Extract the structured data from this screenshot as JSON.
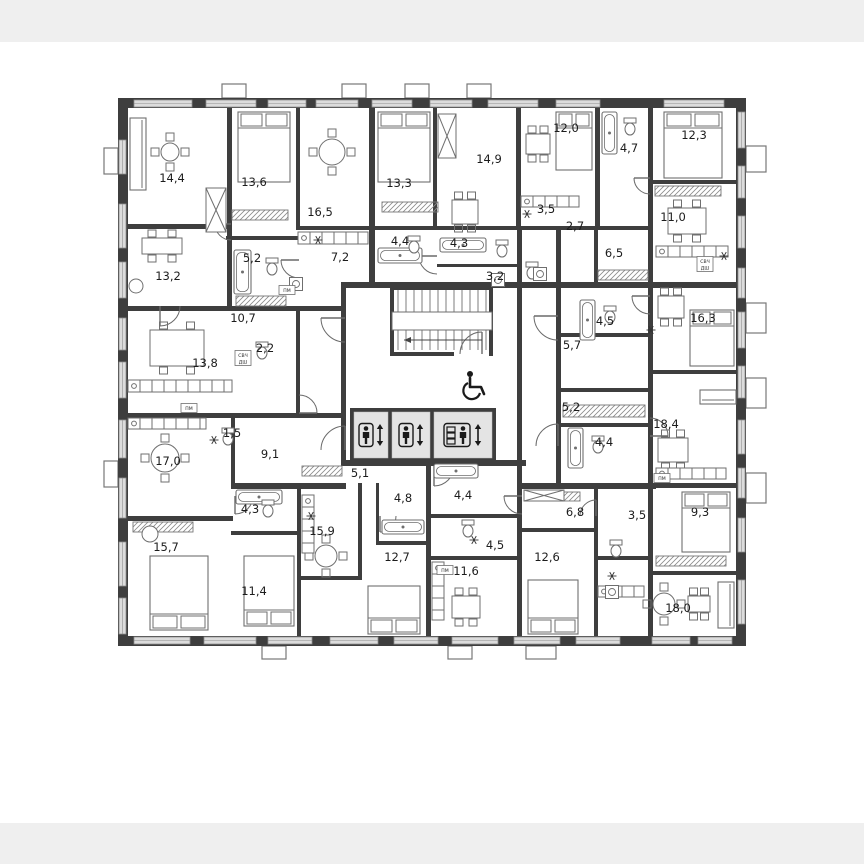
{
  "meta": {
    "bands": {
      "top": [
        0,
        0,
        864,
        42
      ],
      "bottom": [
        0,
        823,
        864,
        41
      ],
      "color": "#efefef"
    },
    "colors": {
      "paper": "#ffffff",
      "wall": "#3e3e3e",
      "window_fill": "#dcdcdc",
      "window_stroke": "#909090",
      "furn": "#6f6f6f",
      "hatch": "#8a8a8a",
      "lift_fill": "#e4e4e4",
      "icon": "#1a1a1a",
      "label": "#1c1c1c",
      "door": "#6a6a6a"
    }
  },
  "plan": {
    "base": [
      118,
      98,
      628,
      548
    ],
    "walls": [
      [
        118,
        98,
        628,
        10
      ],
      [
        118,
        636,
        628,
        10
      ],
      [
        118,
        98,
        10,
        548
      ],
      [
        736,
        98,
        10,
        548
      ],
      [
        227,
        108,
        5,
        198
      ],
      [
        296,
        108,
        4,
        120
      ],
      [
        369,
        108,
        6,
        176
      ],
      [
        433,
        108,
        4,
        120
      ],
      [
        516,
        108,
        5,
        120
      ],
      [
        595,
        108,
        5,
        120
      ],
      [
        648,
        108,
        5,
        538
      ],
      [
        126,
        224,
        101,
        5
      ],
      [
        226,
        236,
        74,
        4
      ],
      [
        296,
        226,
        141,
        4
      ],
      [
        433,
        226,
        217,
        4
      ],
      [
        648,
        180,
        89,
        4
      ],
      [
        648,
        370,
        89,
        4
      ],
      [
        648,
        483,
        89,
        5
      ],
      [
        648,
        571,
        89,
        4
      ],
      [
        341,
        282,
        405,
        6
      ],
      [
        126,
        306,
        220,
        5
      ],
      [
        126,
        413,
        220,
        5
      ],
      [
        126,
        516,
        107,
        5
      ],
      [
        296,
        306,
        4,
        107
      ],
      [
        231,
        413,
        4,
        70
      ],
      [
        556,
        230,
        5,
        253
      ],
      [
        517,
        228,
        5,
        418
      ],
      [
        594,
        230,
        4,
        54
      ],
      [
        556,
        333,
        92,
        4
      ],
      [
        556,
        388,
        92,
        4
      ],
      [
        556,
        423,
        92,
        4
      ],
      [
        341,
        282,
        5,
        178
      ],
      [
        231,
        483,
        115,
        6
      ],
      [
        341,
        460,
        185,
        6
      ],
      [
        519,
        483,
        137,
        6
      ],
      [
        297,
        483,
        4,
        153
      ],
      [
        358,
        483,
        4,
        97
      ],
      [
        426,
        460,
        5,
        176
      ],
      [
        376,
        483,
        3,
        60
      ],
      [
        376,
        541,
        54,
        4
      ],
      [
        428,
        514,
        92,
        4
      ],
      [
        428,
        556,
        92,
        4
      ],
      [
        517,
        528,
        80,
        4
      ],
      [
        594,
        483,
        4,
        155
      ],
      [
        594,
        556,
        56,
        4
      ],
      [
        231,
        531,
        68,
        4
      ],
      [
        300,
        576,
        58,
        4
      ],
      [
        437,
        264,
        82,
        3
      ],
      [
        390,
        286,
        4,
        70
      ],
      [
        489,
        286,
        4,
        70
      ],
      [
        390,
        286,
        103,
        4
      ],
      [
        390,
        352,
        64,
        4
      ],
      [
        350,
        408,
        146,
        4
      ],
      [
        350,
        458,
        146,
        4
      ],
      [
        350,
        408,
        4,
        54
      ],
      [
        492,
        408,
        4,
        54
      ],
      [
        388,
        408,
        4,
        54
      ],
      [
        430,
        408,
        4,
        54
      ]
    ],
    "windows": [
      [
        134,
        100,
        58,
        7
      ],
      [
        206,
        100,
        50,
        7
      ],
      [
        268,
        100,
        38,
        7
      ],
      [
        316,
        100,
        42,
        7
      ],
      [
        372,
        100,
        40,
        7
      ],
      [
        430,
        100,
        42,
        7
      ],
      [
        488,
        100,
        50,
        7
      ],
      [
        556,
        100,
        44,
        7
      ],
      [
        664,
        100,
        60,
        7
      ],
      [
        134,
        637,
        56,
        7
      ],
      [
        204,
        637,
        52,
        7
      ],
      [
        268,
        637,
        44,
        7
      ],
      [
        330,
        637,
        48,
        7
      ],
      [
        394,
        637,
        44,
        7
      ],
      [
        452,
        637,
        46,
        7
      ],
      [
        514,
        637,
        46,
        7
      ],
      [
        576,
        637,
        44,
        7
      ],
      [
        652,
        637,
        38,
        7
      ],
      [
        698,
        637,
        34,
        7
      ],
      [
        119,
        140,
        7,
        34
      ],
      [
        119,
        204,
        7,
        44
      ],
      [
        119,
        262,
        7,
        36
      ],
      [
        119,
        318,
        7,
        32
      ],
      [
        119,
        362,
        7,
        36
      ],
      [
        119,
        420,
        7,
        38
      ],
      [
        119,
        478,
        7,
        40
      ],
      [
        119,
        542,
        7,
        44
      ],
      [
        119,
        598,
        7,
        36
      ],
      [
        738,
        112,
        7,
        36
      ],
      [
        738,
        166,
        7,
        32
      ],
      [
        738,
        216,
        7,
        32
      ],
      [
        738,
        268,
        7,
        30
      ],
      [
        738,
        312,
        7,
        36
      ],
      [
        738,
        366,
        7,
        32
      ],
      [
        738,
        420,
        7,
        34
      ],
      [
        738,
        468,
        7,
        30
      ],
      [
        738,
        518,
        7,
        34
      ],
      [
        738,
        580,
        7,
        44
      ]
    ],
    "protrusions": [
      [
        222,
        84,
        24,
        14
      ],
      [
        342,
        84,
        24,
        14
      ],
      [
        405,
        84,
        24,
        14
      ],
      [
        467,
        84,
        24,
        14
      ],
      [
        262,
        646,
        24,
        13
      ],
      [
        448,
        646,
        24,
        13
      ],
      [
        526,
        646,
        30,
        13
      ],
      [
        104,
        148,
        14,
        26
      ],
      [
        104,
        461,
        14,
        26
      ],
      [
        746,
        146,
        20,
        26
      ],
      [
        746,
        303,
        20,
        30
      ],
      [
        746,
        378,
        20,
        30
      ],
      [
        746,
        473,
        20,
        30
      ]
    ],
    "hatches": [
      [
        232,
        210,
        56,
        10
      ],
      [
        382,
        202,
        56,
        10
      ],
      [
        655,
        186,
        66,
        10
      ],
      [
        563,
        405,
        82,
        12
      ],
      [
        302,
        466,
        40,
        10
      ],
      [
        133,
        522,
        60,
        10
      ],
      [
        524,
        492,
        56,
        9
      ],
      [
        656,
        556,
        70,
        10
      ],
      [
        598,
        270,
        50,
        10
      ],
      [
        236,
        296,
        50,
        10
      ]
    ],
    "doors": [
      [
        345,
        318,
        24,
        90
      ],
      [
        345,
        450,
        24,
        180
      ],
      [
        558,
        316,
        24,
        90
      ],
      [
        558,
        446,
        22,
        180
      ],
      [
        434,
        466,
        20,
        0
      ],
      [
        299,
        260,
        18,
        90
      ],
      [
        437,
        256,
        18,
        90
      ],
      [
        650,
        296,
        18,
        90
      ],
      [
        650,
        436,
        18,
        270
      ],
      [
        235,
        496,
        18,
        0
      ],
      [
        380,
        516,
        16,
        0
      ],
      [
        522,
        496,
        18,
        90
      ],
      [
        596,
        516,
        16,
        180
      ],
      [
        160,
        306,
        20,
        0
      ],
      [
        482,
        354,
        22,
        180
      ],
      [
        650,
        178,
        16,
        90
      ],
      [
        299,
        413,
        18,
        270
      ],
      [
        231,
        224,
        16,
        90
      ]
    ],
    "rooms": [
      {
        "label": "14,4",
        "x": 172,
        "y": 182
      },
      {
        "label": "13,6",
        "x": 254,
        "y": 186
      },
      {
        "label": "16,5",
        "x": 320,
        "y": 216
      },
      {
        "label": "13,3",
        "x": 399,
        "y": 187
      },
      {
        "label": "14,9",
        "x": 489,
        "y": 163
      },
      {
        "label": "12,0",
        "x": 566,
        "y": 132
      },
      {
        "label": "4,7",
        "x": 629,
        "y": 152
      },
      {
        "label": "12,3",
        "x": 694,
        "y": 139
      },
      {
        "label": "11,0",
        "x": 673,
        "y": 221
      },
      {
        "label": "3,5",
        "x": 546,
        "y": 213
      },
      {
        "label": "2,7",
        "x": 575,
        "y": 230
      },
      {
        "label": "6,5",
        "x": 614,
        "y": 257
      },
      {
        "label": "16,3",
        "x": 703,
        "y": 322
      },
      {
        "label": "5,2",
        "x": 252,
        "y": 262
      },
      {
        "label": "7,2",
        "x": 340,
        "y": 261
      },
      {
        "label": "13,2",
        "x": 168,
        "y": 280
      },
      {
        "label": "4,4",
        "x": 400,
        "y": 245
      },
      {
        "label": "4,3",
        "x": 459,
        "y": 247
      },
      {
        "label": "3,2",
        "x": 495,
        "y": 280
      },
      {
        "label": "10,7",
        "x": 243,
        "y": 322
      },
      {
        "label": "2,2",
        "x": 265,
        "y": 352
      },
      {
        "label": "13,8",
        "x": 205,
        "y": 367
      },
      {
        "label": "4,5",
        "x": 605,
        "y": 325
      },
      {
        "label": "5,7",
        "x": 572,
        "y": 349
      },
      {
        "label": "1,5",
        "x": 232,
        "y": 437
      },
      {
        "label": "17,0",
        "x": 168,
        "y": 465
      },
      {
        "label": "9,1",
        "x": 270,
        "y": 458
      },
      {
        "label": "5,2",
        "x": 571,
        "y": 411
      },
      {
        "label": "4,4",
        "x": 604,
        "y": 446
      },
      {
        "label": "18,4",
        "x": 666,
        "y": 428
      },
      {
        "label": "5,1",
        "x": 360,
        "y": 477
      },
      {
        "label": "4,8",
        "x": 403,
        "y": 502
      },
      {
        "label": "4,4",
        "x": 463,
        "y": 499
      },
      {
        "label": "4,5",
        "x": 495,
        "y": 549
      },
      {
        "label": "6,8",
        "x": 575,
        "y": 516
      },
      {
        "label": "3,5",
        "x": 637,
        "y": 519
      },
      {
        "label": "9,3",
        "x": 700,
        "y": 516
      },
      {
        "label": "15,7",
        "x": 166,
        "y": 551
      },
      {
        "label": "4,3",
        "x": 250,
        "y": 513
      },
      {
        "label": "15,9",
        "x": 322,
        "y": 535
      },
      {
        "label": "12,7",
        "x": 397,
        "y": 561
      },
      {
        "label": "11,6",
        "x": 466,
        "y": 575
      },
      {
        "label": "12,6",
        "x": 547,
        "y": 561
      },
      {
        "label": "11,4",
        "x": 254,
        "y": 595
      },
      {
        "label": "18,0",
        "x": 678,
        "y": 612
      }
    ],
    "furniture": {
      "beds": [
        [
          238,
          112,
          52,
          70,
          0
        ],
        [
          378,
          112,
          52,
          70,
          0
        ],
        [
          664,
          112,
          58,
          66,
          0
        ],
        [
          690,
          310,
          44,
          56,
          0
        ],
        [
          556,
          112,
          36,
          58,
          0
        ],
        [
          682,
          492,
          48,
          60,
          0
        ],
        [
          150,
          556,
          58,
          74,
          1
        ],
        [
          244,
          556,
          50,
          70,
          1
        ],
        [
          368,
          586,
          52,
          48,
          1
        ],
        [
          528,
          580,
          50,
          54,
          1
        ]
      ],
      "sofas": [
        [
          130,
          118,
          16,
          72
        ],
        [
          700,
          390,
          36,
          14
        ],
        [
          718,
          582,
          16,
          46
        ]
      ],
      "round_tables": [
        [
          170,
          152,
          9
        ],
        [
          332,
          152,
          13
        ],
        [
          165,
          458,
          14
        ],
        [
          326,
          556,
          11
        ],
        [
          664,
          604,
          11
        ]
      ],
      "tables": [
        [
          150,
          330,
          54,
          36
        ],
        [
          452,
          200,
          26,
          24
        ],
        [
          668,
          208,
          38,
          26
        ],
        [
          526,
          134,
          24,
          20
        ],
        [
          658,
          296,
          26,
          22
        ],
        [
          658,
          438,
          30,
          24
        ],
        [
          452,
          596,
          28,
          22
        ],
        [
          688,
          596,
          22,
          16
        ],
        [
          142,
          238,
          40,
          16
        ]
      ],
      "kitchens": [
        [
          298,
          232,
          70,
          12
        ],
        [
          521,
          196,
          58,
          11
        ],
        [
          656,
          246,
          72,
          11
        ],
        [
          128,
          380,
          104,
          12
        ],
        [
          128,
          418,
          78,
          11
        ],
        [
          302,
          495,
          12,
          58
        ],
        [
          432,
          562,
          12,
          58
        ],
        [
          656,
          468,
          70,
          11
        ],
        [
          598,
          586,
          46,
          11
        ]
      ],
      "tubs": [
        [
          234,
          250,
          17,
          44
        ],
        [
          378,
          248,
          44,
          15
        ],
        [
          440,
          238,
          46,
          14
        ],
        [
          602,
          112,
          15,
          42
        ],
        [
          580,
          300,
          15,
          40
        ],
        [
          568,
          428,
          15,
          40
        ],
        [
          236,
          490,
          46,
          14
        ],
        [
          382,
          520,
          42,
          14
        ],
        [
          434,
          464,
          44,
          14
        ]
      ],
      "wcs": [
        [
          272,
          258
        ],
        [
          414,
          236
        ],
        [
          502,
          240
        ],
        [
          630,
          118
        ],
        [
          532,
          262
        ],
        [
          610,
          306
        ],
        [
          598,
          436
        ],
        [
          262,
          342
        ],
        [
          228,
          428
        ],
        [
          268,
          500
        ],
        [
          468,
          520
        ],
        [
          616,
          540
        ]
      ],
      "wms": [
        [
          296,
          284
        ],
        [
          498,
          280
        ],
        [
          540,
          274
        ],
        [
          612,
          592
        ]
      ],
      "wardrobes": [
        [
          206,
          188,
          20,
          44
        ],
        [
          438,
          114,
          18,
          44
        ],
        [
          524,
          490,
          40,
          11
        ]
      ],
      "chairs": [
        [
          150,
          534,
          8
        ],
        [
          136,
          286,
          7
        ]
      ]
    },
    "snowflakes": [
      [
        318,
        240
      ],
      [
        527,
        214
      ],
      [
        724,
        256
      ],
      [
        651,
        330
      ],
      [
        214,
        440
      ],
      [
        311,
        516
      ],
      [
        474,
        540
      ],
      [
        612,
        576
      ]
    ],
    "appliance_labels": [
      {
        "lines": [
          "ПМ"
        ],
        "x": 287,
        "y": 290
      },
      {
        "lines": [
          "ПМ"
        ],
        "x": 662,
        "y": 478
      },
      {
        "lines": [
          "ПМ"
        ],
        "x": 189,
        "y": 408
      },
      {
        "lines": [
          "ПМ"
        ],
        "x": 445,
        "y": 570
      },
      {
        "lines": [
          "СВЧ",
          "ДШ"
        ],
        "x": 243,
        "y": 358
      },
      {
        "lines": [
          "СВЧ",
          "ДШ"
        ],
        "x": 705,
        "y": 264
      }
    ],
    "stairs": {
      "x": 394,
      "y": 290,
      "w": 96,
      "h": 62,
      "landing": [
        392,
        312,
        100,
        18
      ]
    },
    "lifts": {
      "cells": [
        {
          "rect": [
            354,
            412,
            34,
            46
          ],
          "type": "passenger"
        },
        {
          "rect": [
            392,
            412,
            38,
            46
          ],
          "type": "passenger"
        },
        {
          "rect": [
            434,
            412,
            58,
            46
          ],
          "type": "cargo"
        }
      ]
    },
    "wheelchair": {
      "x": 472,
      "y": 386
    }
  }
}
